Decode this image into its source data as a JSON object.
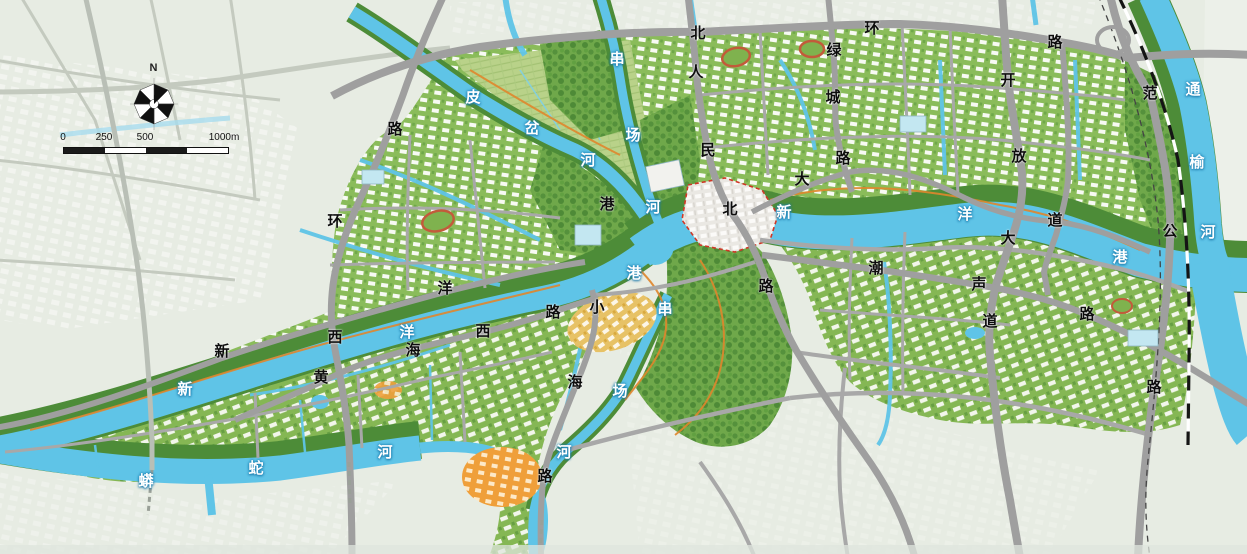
{
  "map": {
    "compass": {
      "north_label": "N"
    },
    "scale_bar": {
      "labels": [
        "0",
        "250",
        "500",
        "1000m"
      ]
    },
    "labels": [
      {
        "name": "北环路",
        "kind": "road",
        "chars": [
          {
            "t": "北",
            "x": 698,
            "y": 34
          },
          {
            "t": "环",
            "x": 872,
            "y": 29
          },
          {
            "t": "路",
            "x": 1055,
            "y": 43
          }
        ]
      },
      {
        "name": "西环路",
        "kind": "road",
        "chars": [
          {
            "t": "路",
            "x": 395,
            "y": 130
          },
          {
            "t": "环",
            "x": 335,
            "y": 222
          },
          {
            "t": "西",
            "x": 335,
            "y": 338
          }
        ]
      },
      {
        "name": "人民北路",
        "kind": "road",
        "chars": [
          {
            "t": "人",
            "x": 696,
            "y": 73
          },
          {
            "t": "民",
            "x": 708,
            "y": 151
          },
          {
            "t": "北",
            "x": 730,
            "y": 210
          },
          {
            "t": "路",
            "x": 766,
            "y": 287
          }
        ]
      },
      {
        "name": "绿城路",
        "kind": "road",
        "chars": [
          {
            "t": "绿",
            "x": 834,
            "y": 51
          },
          {
            "t": "城",
            "x": 833,
            "y": 98
          },
          {
            "t": "路",
            "x": 843,
            "y": 159
          }
        ]
      },
      {
        "name": "开放大道",
        "kind": "road",
        "chars": [
          {
            "t": "开",
            "x": 1008,
            "y": 81
          },
          {
            "t": "放",
            "x": 1019,
            "y": 157
          },
          {
            "t": "大",
            "x": 1008,
            "y": 239
          },
          {
            "t": "道",
            "x": 990,
            "y": 322
          }
        ]
      },
      {
        "name": "大道",
        "kind": "road",
        "chars": [
          {
            "t": "大",
            "x": 802,
            "y": 180
          },
          {
            "t": "道",
            "x": 1055,
            "y": 221
          }
        ]
      },
      {
        "name": "潮声路",
        "kind": "road",
        "chars": [
          {
            "t": "潮",
            "x": 876,
            "y": 269
          },
          {
            "t": "声",
            "x": 979,
            "y": 285
          },
          {
            "t": "路",
            "x": 1087,
            "y": 315
          }
        ]
      },
      {
        "name": "范公路",
        "kind": "road",
        "chars": [
          {
            "t": "范",
            "x": 1150,
            "y": 94
          },
          {
            "t": "公",
            "x": 1170,
            "y": 232
          },
          {
            "t": "路",
            "x": 1154,
            "y": 388
          }
        ]
      },
      {
        "name": "新洋路",
        "kind": "road",
        "chars": [
          {
            "t": "新",
            "x": 222,
            "y": 352
          },
          {
            "t": "洋",
            "x": 445,
            "y": 289
          }
        ]
      },
      {
        "name": "黄海西路",
        "kind": "road",
        "chars": [
          {
            "t": "黄",
            "x": 321,
            "y": 378
          },
          {
            "t": "海",
            "x": 413,
            "y": 351
          },
          {
            "t": "西",
            "x": 483,
            "y": 332
          },
          {
            "t": "路",
            "x": 553,
            "y": 313
          }
        ]
      },
      {
        "name": "小海路",
        "kind": "road",
        "chars": [
          {
            "t": "小",
            "x": 597,
            "y": 308
          },
          {
            "t": "海",
            "x": 575,
            "y": 383
          },
          {
            "t": "路",
            "x": 545,
            "y": 477
          }
        ]
      },
      {
        "name": "港",
        "kind": "road",
        "chars": [
          {
            "t": "港",
            "x": 607,
            "y": 205
          }
        ]
      },
      {
        "name": "串场河",
        "kind": "river",
        "chars": [
          {
            "t": "串",
            "x": 617,
            "y": 60
          },
          {
            "t": "场",
            "x": 633,
            "y": 136
          },
          {
            "t": "河",
            "x": 653,
            "y": 208
          }
        ]
      },
      {
        "name": "皮岔河",
        "kind": "river",
        "chars": [
          {
            "t": "皮",
            "x": 473,
            "y": 98
          },
          {
            "t": "岔",
            "x": 532,
            "y": 129
          },
          {
            "t": "河",
            "x": 588,
            "y": 161
          }
        ]
      },
      {
        "name": "新洋港东",
        "kind": "river",
        "chars": [
          {
            "t": "新",
            "x": 784,
            "y": 213
          },
          {
            "t": "洋",
            "x": 965,
            "y": 215
          },
          {
            "t": "港",
            "x": 1120,
            "y": 258
          }
        ]
      },
      {
        "name": "新洋港西",
        "kind": "river",
        "chars": [
          {
            "t": "新",
            "x": 185,
            "y": 390
          },
          {
            "t": "洋",
            "x": 407,
            "y": 333
          },
          {
            "t": "港",
            "x": 634,
            "y": 274
          }
        ]
      },
      {
        "name": "通榆河",
        "kind": "river",
        "chars": [
          {
            "t": "通",
            "x": 1193,
            "y": 90
          },
          {
            "t": "榆",
            "x": 1197,
            "y": 163
          },
          {
            "t": "河",
            "x": 1208,
            "y": 233
          }
        ]
      },
      {
        "name": "串场河南",
        "kind": "river",
        "chars": [
          {
            "t": "串",
            "x": 665,
            "y": 310
          },
          {
            "t": "场",
            "x": 620,
            "y": 392
          },
          {
            "t": "河",
            "x": 564,
            "y": 453
          }
        ]
      },
      {
        "name": "蟒蛇河",
        "kind": "river",
        "chars": [
          {
            "t": "蟒",
            "x": 146,
            "y": 482
          },
          {
            "t": "蛇",
            "x": 256,
            "y": 469
          },
          {
            "t": "河",
            "x": 385,
            "y": 453
          }
        ]
      }
    ],
    "colors": {
      "base": "#e7ece3",
      "water": "#5fc4e7",
      "urban_green": "#8abc5a",
      "tree_green": "#5d9a41",
      "road_grey": "#9f9f9f",
      "faded_road": "#c4cabf",
      "road_label": "#0d0d0d",
      "river_label": "#ffffff",
      "river_label_halo": "#1982b4",
      "park_path_orange": "#e0862c",
      "old_town_boundary": "#cf3726",
      "railway_black": "#151515",
      "farm": "#b9d289",
      "dev_orange": "#ef9f3a",
      "dev_yellow": "#e7c266",
      "glass_blue": "#c3e7f1"
    }
  }
}
